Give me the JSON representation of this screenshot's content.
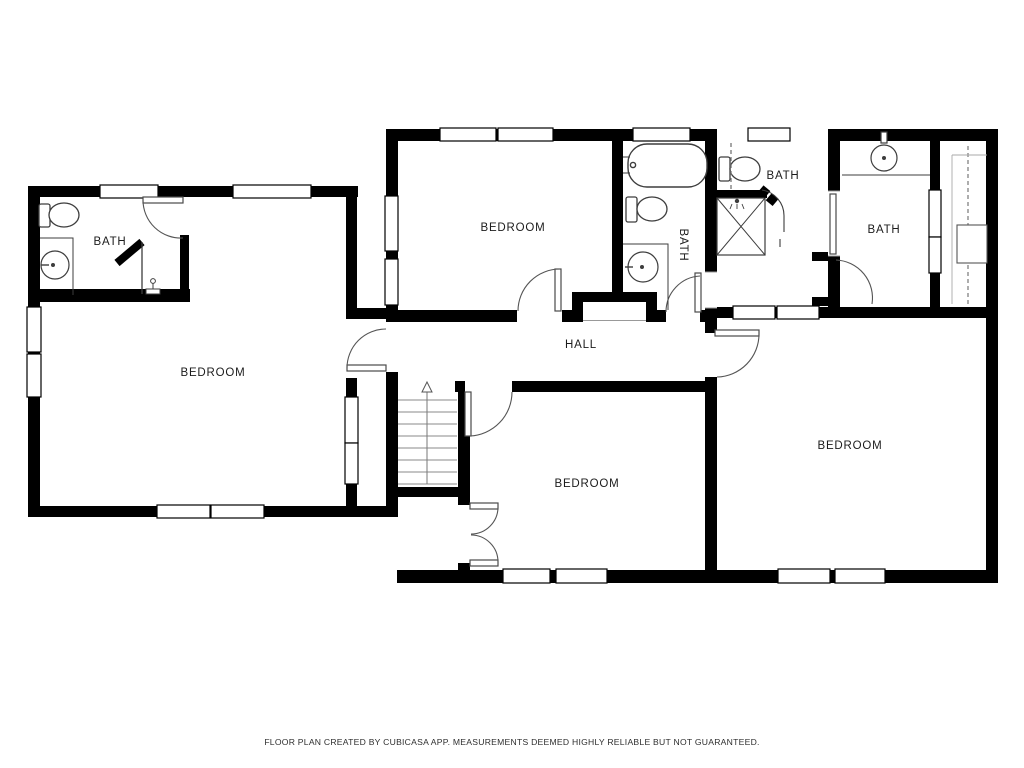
{
  "footer": {
    "disclaimer": "FLOOR PLAN CREATED BY CUBICASA APP. MEASUREMENTS DEEMED HIGHLY RELIABLE BUT NOT GUARANTEED."
  },
  "rooms": {
    "bath_top_left": {
      "label": "BATH"
    },
    "bedroom_left": {
      "label": "BEDROOM"
    },
    "bedroom_top": {
      "label": "BEDROOM"
    },
    "bath_center": {
      "label": "BATH"
    },
    "bath_middle": {
      "label": "BATH"
    },
    "bath_right": {
      "label": "BATH"
    },
    "hall": {
      "label": "HALL"
    },
    "bedroom_bottom": {
      "label": "BEDROOM"
    },
    "bedroom_right": {
      "label": "BEDROOM"
    }
  },
  "colors": {
    "wall": "#000000",
    "floor": "#ffffff",
    "fixture": "#3d3d3d",
    "arc": "#555555"
  }
}
